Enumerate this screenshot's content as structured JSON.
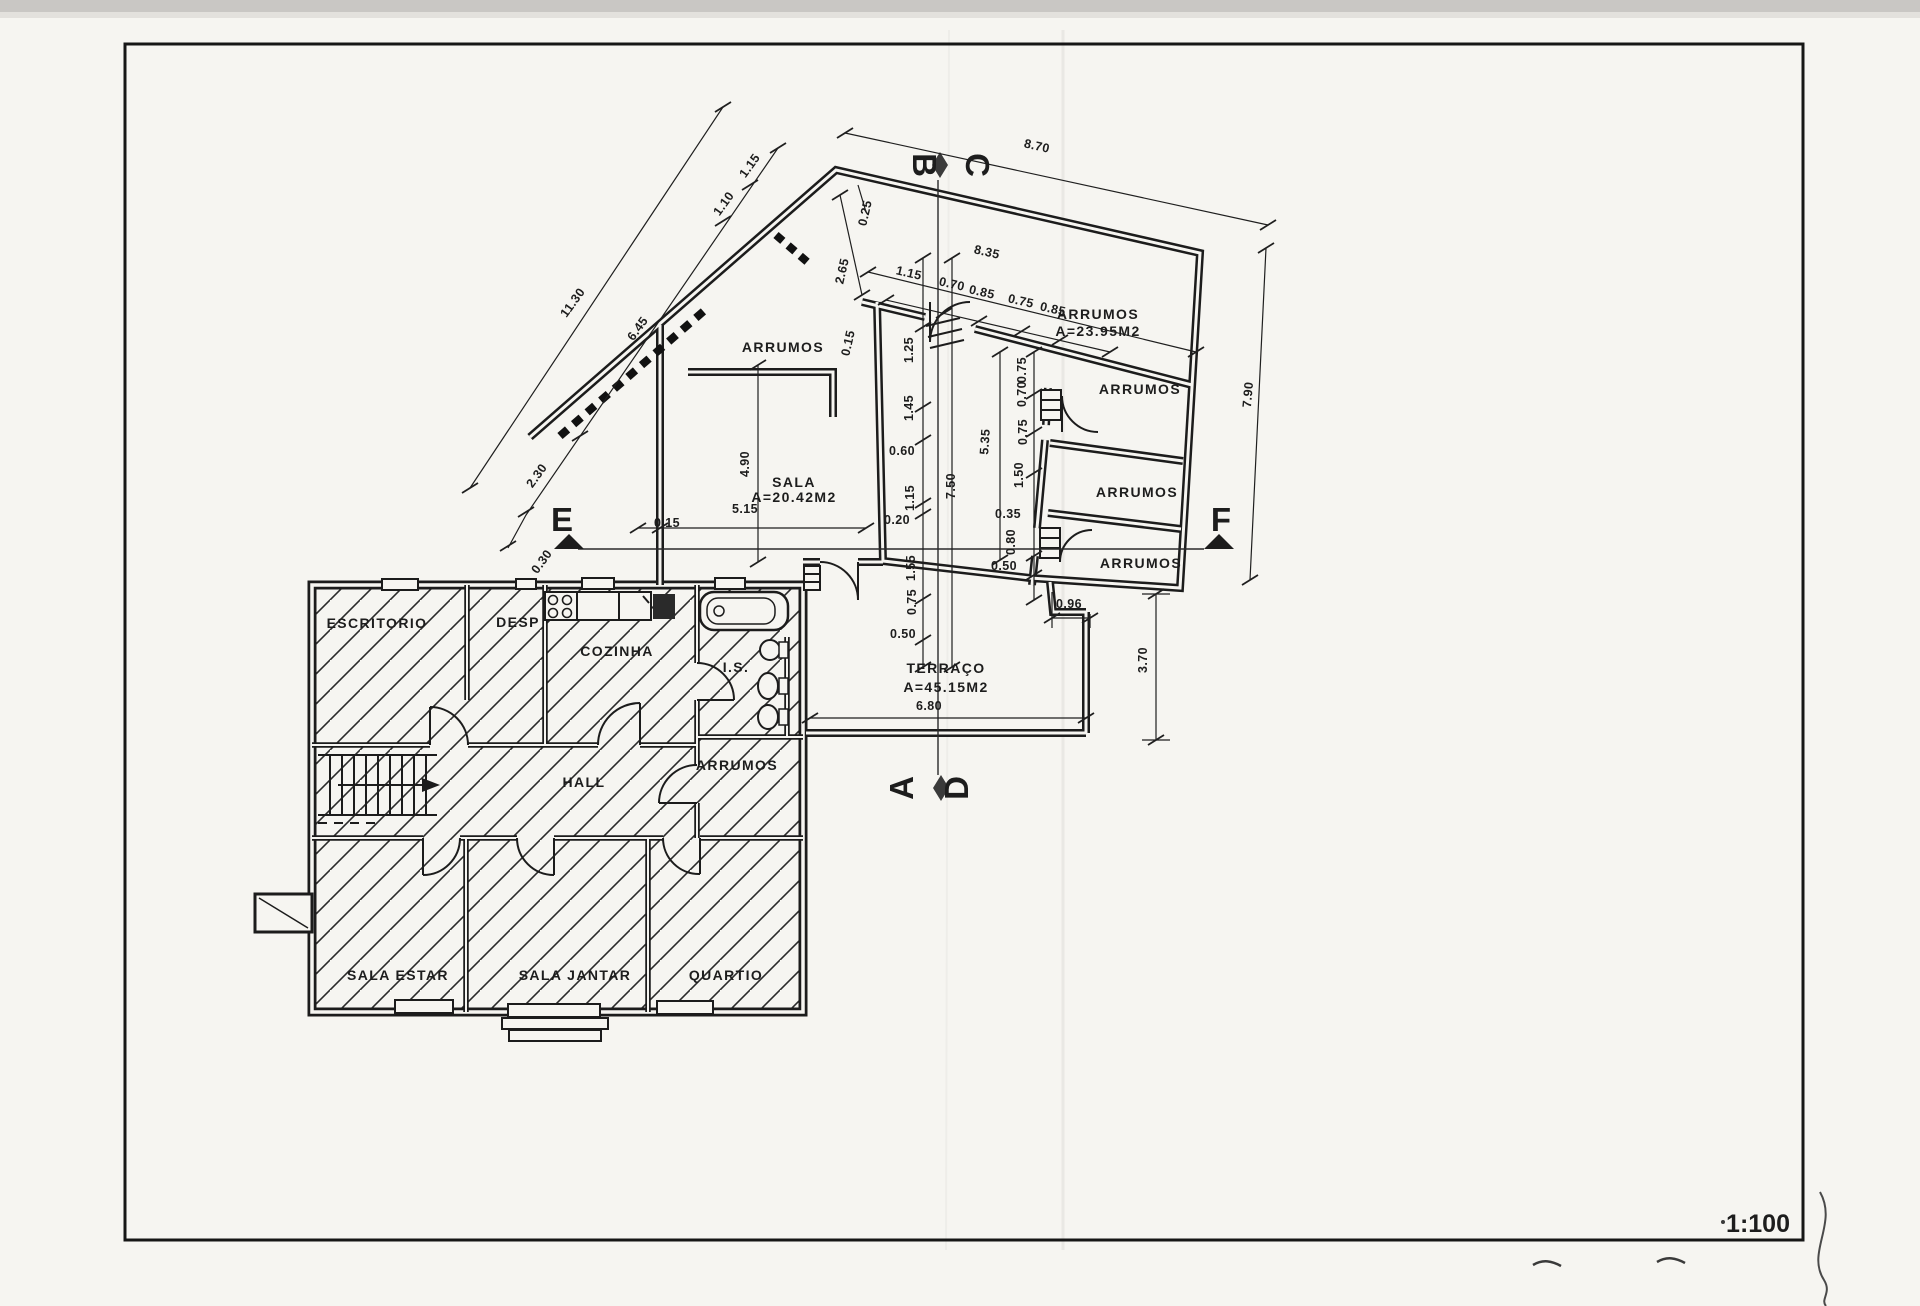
{
  "sheet": {
    "scale_label": "1:100",
    "paper_color": "#f6f5f1",
    "ink_color": "#1f1f1f"
  },
  "labels": {
    "rooms": [
      {
        "t": "ARRUMOS",
        "x": 783,
        "y": 352
      },
      {
        "t": "ARRUMOS",
        "x": 1098,
        "y": 319,
        "a": "start"
      },
      {
        "t": "A=23.95M2",
        "x": 1098,
        "y": 336,
        "a": "start"
      },
      {
        "t": "ARRUMOS",
        "x": 1140,
        "y": 394
      },
      {
        "t": "ARRUMOS",
        "x": 1137,
        "y": 497
      },
      {
        "t": "ARRUMOS",
        "x": 1141,
        "y": 568
      },
      {
        "t": "SALA",
        "x": 794,
        "y": 487,
        "a": "start"
      },
      {
        "t": "A=20.42M2",
        "x": 794,
        "y": 502,
        "a": "start"
      },
      {
        "t": "TERRAÇO",
        "x": 946,
        "y": 673,
        "a": "start"
      },
      {
        "t": "A=45.15M2",
        "x": 946,
        "y": 692,
        "a": "start"
      },
      {
        "t": "ESCRITORIO",
        "x": 377,
        "y": 628
      },
      {
        "t": "DESP",
        "x": 518,
        "y": 627
      },
      {
        "t": "COZINHA",
        "x": 617,
        "y": 656
      },
      {
        "t": "I.S.",
        "x": 736,
        "y": 672
      },
      {
        "t": "HALL",
        "x": 584,
        "y": 787
      },
      {
        "t": "ARRUMOS",
        "x": 737,
        "y": 770
      },
      {
        "t": "SALA ESTAR",
        "x": 398,
        "y": 980
      },
      {
        "t": "SALA JANTAR",
        "x": 575,
        "y": 980
      },
      {
        "t": "QUARTIO",
        "x": 726,
        "y": 980
      }
    ],
    "dimensions": [
      {
        "t": "8.70",
        "x": 1036,
        "y": 150,
        "r": 13
      },
      {
        "t": "0.25",
        "x": 869,
        "y": 214,
        "r": -77
      },
      {
        "t": "8.35",
        "x": 986,
        "y": 256,
        "r": 13
      },
      {
        "t": "2.65",
        "x": 846,
        "y": 272,
        "r": -77
      },
      {
        "t": "1.15",
        "x": 908,
        "y": 277,
        "r": 13
      },
      {
        "t": "0.70",
        "x": 951,
        "y": 288,
        "r": 13
      },
      {
        "t": "0.85",
        "x": 981,
        "y": 296,
        "r": 13
      },
      {
        "t": "0.75",
        "x": 1020,
        "y": 305,
        "r": 13
      },
      {
        "t": "0.85",
        "x": 1052,
        "y": 313,
        "r": 13
      },
      {
        "t": "11.30",
        "x": 576,
        "y": 305,
        "r": -54
      },
      {
        "t": "6.45",
        "x": 641,
        "y": 331,
        "r": -54
      },
      {
        "t": "1.10",
        "x": 727,
        "y": 206,
        "r": -54
      },
      {
        "t": "1.15",
        "x": 753,
        "y": 168,
        "r": -54
      },
      {
        "t": "2.30",
        "x": 540,
        "y": 478,
        "r": -54
      },
      {
        "t": "0.30",
        "x": 545,
        "y": 564,
        "r": -54
      },
      {
        "t": "0.15",
        "x": 852,
        "y": 344,
        "r": -77
      },
      {
        "t": "0.15",
        "x": 667,
        "y": 527,
        "s": 11
      },
      {
        "t": "5.15",
        "x": 745,
        "y": 513
      },
      {
        "t": "4.90",
        "x": 749,
        "y": 464,
        "r": -90
      },
      {
        "t": "1.25",
        "x": 913,
        "y": 350,
        "r": -90
      },
      {
        "t": "1.45",
        "x": 913,
        "y": 408,
        "r": -90
      },
      {
        "t": "0.60",
        "x": 902,
        "y": 455
      },
      {
        "t": "1.15",
        "x": 914,
        "y": 498,
        "r": -90
      },
      {
        "t": "0.20",
        "x": 897,
        "y": 524
      },
      {
        "t": "1.55",
        "x": 915,
        "y": 568,
        "r": -90
      },
      {
        "t": "0.75",
        "x": 916,
        "y": 602,
        "r": -90
      },
      {
        "t": "0.50",
        "x": 903,
        "y": 638
      },
      {
        "t": "7.50",
        "x": 955,
        "y": 486,
        "r": -90
      },
      {
        "t": "0.75",
        "x": 1026,
        "y": 370,
        "r": -90
      },
      {
        "t": "0.70",
        "x": 1026,
        "y": 394,
        "r": -90
      },
      {
        "t": "0.75",
        "x": 1027,
        "y": 432,
        "r": -90
      },
      {
        "t": "1.50",
        "x": 1023,
        "y": 475,
        "r": -90
      },
      {
        "t": "5.35",
        "x": 989,
        "y": 442,
        "r": -86
      },
      {
        "t": "0.35",
        "x": 1008,
        "y": 518
      },
      {
        "t": "0.80",
        "x": 1015,
        "y": 542,
        "r": -90
      },
      {
        "t": "0.50",
        "x": 1004,
        "y": 570
      },
      {
        "t": "0.96",
        "x": 1069,
        "y": 608
      },
      {
        "t": "7.90",
        "x": 1252,
        "y": 395,
        "r": -85
      },
      {
        "t": "3.70",
        "x": 1147,
        "y": 660,
        "r": -90
      },
      {
        "t": "6.80",
        "x": 929,
        "y": 710
      }
    ],
    "sections": [
      {
        "t": "B",
        "x": 913,
        "y": 165,
        "r": 90
      },
      {
        "t": "C",
        "x": 966,
        "y": 165,
        "r": 90
      },
      {
        "t": "A",
        "x": 913,
        "y": 788,
        "r": -90
      },
      {
        "t": "D",
        "x": 968,
        "y": 788,
        "r": -90
      },
      {
        "t": "E",
        "x": 562,
        "y": 531
      },
      {
        "t": "F",
        "x": 1221,
        "y": 531
      }
    ]
  }
}
